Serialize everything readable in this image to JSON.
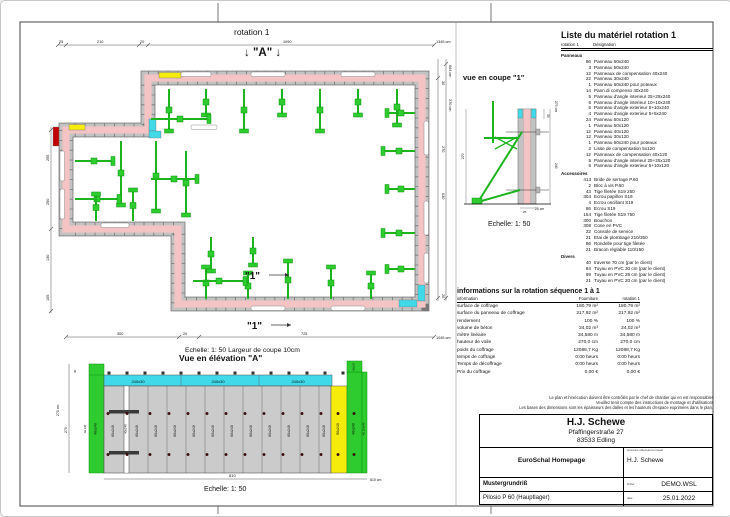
{
  "plan": {
    "title": "rotation 1",
    "marker_a": "↓ \"A\" ↓",
    "marker_1": "\"1\"",
    "scale_note": "Echelle: 1: 50   Largeur de coupe 10cm",
    "dims": {
      "top": [
        "25",
        "210",
        "20",
        "1090"
      ],
      "top_total": "1345 cm",
      "bottom": [
        "300",
        "20",
        "725"
      ],
      "bottom_total": "1045 cm",
      "left": [
        "255",
        "250",
        "130",
        "105"
      ],
      "right": [
        "664 cm",
        "30",
        "270 cm",
        "270",
        "630",
        "20"
      ]
    }
  },
  "section": {
    "title": "vue en coupe \"1\"",
    "scale": "Echelle: 1: 50",
    "dims": {
      "height_in": "270",
      "top_cap": "30",
      "height_out": "270 cm",
      "lower": "240",
      "base_tick": "25",
      "base": "25 cm"
    }
  },
  "elevation": {
    "title": "Vue en élévation \"A\"",
    "scale": "Echelle: 1: 50",
    "panel_labels": {
      "standard": "60x240",
      "comp": "40x240",
      "yellow": "50x240",
      "green": "40x240",
      "edge": "AE 10x240",
      "cap": "40x120",
      "lisse": "240x30",
      "left_marker": "AE 240"
    },
    "dims": {
      "left_total": "270 cm",
      "left": "270",
      "top": "30",
      "bottom": "810",
      "bottom_total": "810 cm"
    }
  },
  "material_list": {
    "title": "Liste du matériel  rotation 1",
    "col1": "rotation 1",
    "col2": "Désignation",
    "sections": [
      {
        "title": "Panneaux",
        "rows": [
          [
            "86",
            "Panneau 60x240"
          ],
          [
            "3",
            "Panneau 50x240"
          ],
          [
            "12",
            "Panneaux de compensation 40x240"
          ],
          [
            "22",
            "Panneau 30x240"
          ],
          [
            "1",
            "Panneau 60x240 pour poteaux"
          ],
          [
            "14",
            "Pann.di compenso 40x240"
          ],
          [
            "5",
            "Panneau d'angle interieur 25+25x240"
          ],
          [
            "6",
            "Panneau d'angle interieur 10+10x240"
          ],
          [
            "5",
            "Panneau d'angle exterieur 5+10x240"
          ],
          [
            "4",
            "Panneau d'angle exterieur 5+5x240"
          ],
          [
            "24",
            "Panneau 60x120"
          ],
          [
            "1",
            "Panneau 50x120"
          ],
          [
            "12",
            "Panneau 40x120"
          ],
          [
            "12",
            "Panneau 30x120"
          ],
          [
            "1",
            "Panneau 60x240 pour poteaux"
          ],
          [
            "2",
            "Lisse de compensation 5x120"
          ],
          [
            "12",
            "Panneaux de compensation 40x120"
          ],
          [
            "5",
            "Panneau d'angle interieur 25+25x120"
          ],
          [
            "5",
            "Panneau d'angle exterieur 5+10x120"
          ]
        ]
      },
      {
        "title": "Accessoires",
        "rows": [
          [
            "413",
            "Bride de serrage P.60"
          ],
          [
            "2",
            "Bloc à vis P.60"
          ],
          [
            "43",
            "Tige filetée S19 250"
          ],
          [
            "304",
            "Ecrou papillon S19"
          ],
          [
            "4",
            "Ecrou oscillant S19"
          ],
          [
            "86",
            "Ecrou S19"
          ],
          [
            "154",
            "Tige filetée S19 750"
          ],
          [
            "300",
            "Bouchon"
          ],
          [
            "308",
            "Cone en PVC"
          ],
          [
            "22",
            "Console de service"
          ],
          [
            "21",
            "Etai de plombage 210/350"
          ],
          [
            "86",
            "Rondelle pour tige filetée"
          ],
          [
            "21",
            "Bracon réglable 110/150"
          ]
        ]
      },
      {
        "title": "Divers",
        "rows": [
          [
            "40",
            "traverse 70 cm (par le client)"
          ],
          [
            "84",
            "Tuyau en PVC 30 cm (par le client)"
          ],
          [
            "69",
            "Tuyau en PVC 25 cm (par le client)"
          ],
          [
            "21",
            "Tuyau en PVC 20 cm (par le client)"
          ]
        ]
      }
    ]
  },
  "info_table": {
    "title": "informations sur la rotation  séquence 1 à 1",
    "columns": [
      "information",
      "Fourniture",
      "rotation 1"
    ],
    "rows": [
      [
        "surface de coffrage",
        "180,79 m²",
        "180,79 m²"
      ],
      [
        "surface du panneau de coffrage",
        "217,92 m²",
        "217,92 m²"
      ],
      [
        "rendement",
        "100 %",
        "100 %"
      ],
      [
        "volume de béton",
        "24,02 m³",
        "24,02 m³"
      ],
      [
        "mètre linéaire",
        "34,580 m",
        "34,580 m"
      ],
      [
        "hauteur de voile",
        "270,0 cm",
        "270,0 cm"
      ],
      [
        "poids du coffrage",
        "12088,7 Kg",
        "12088,7 Kg"
      ],
      [
        "temps de coffrage",
        "0:00 heurs",
        "0:00 heurs"
      ],
      [
        "Temps de décoffrage",
        "0:00 heurs",
        "0:00 heurs"
      ],
      [
        "Prix du coffrage",
        "0,00 €",
        "0,00 €"
      ]
    ]
  },
  "notes": [
    "Le plan et l'exécution doivent être contrôlés par le chef de chantier qui en est responsable!",
    "Veuillez tenir compte des instructions de montage et d'utilisation!",
    "Les bases des dimensions sont les épaisseurs des dalles et les hauteurs d'espace exprimées dans le plan."
  ],
  "title_block": {
    "company": {
      "name": "H.J. Schewe",
      "street": "Pfaffingerstraße 27",
      "city": "83533 Edling"
    },
    "site": "EuroSchal Homepage",
    "worker_label": "personne effectuant le travail",
    "worker": "H.J. Schewe",
    "plan_name": "Mustergrundriß",
    "file_label": "fichier",
    "file": "DEMO.WSL",
    "formwork": "Pilosio P 60 (Hauptlager)",
    "date_label": "date",
    "date": "25.01.2022"
  },
  "colors": {
    "wall_pink": "#f4c3c3",
    "rail_gray": "#c2c2c2",
    "accent_green": "#2ecc2e",
    "accent_cyan": "#3fd9e9",
    "accent_yellow": "#f6ec0c",
    "accent_red": "#c00000",
    "panel_gray": "#cbcbcb"
  }
}
